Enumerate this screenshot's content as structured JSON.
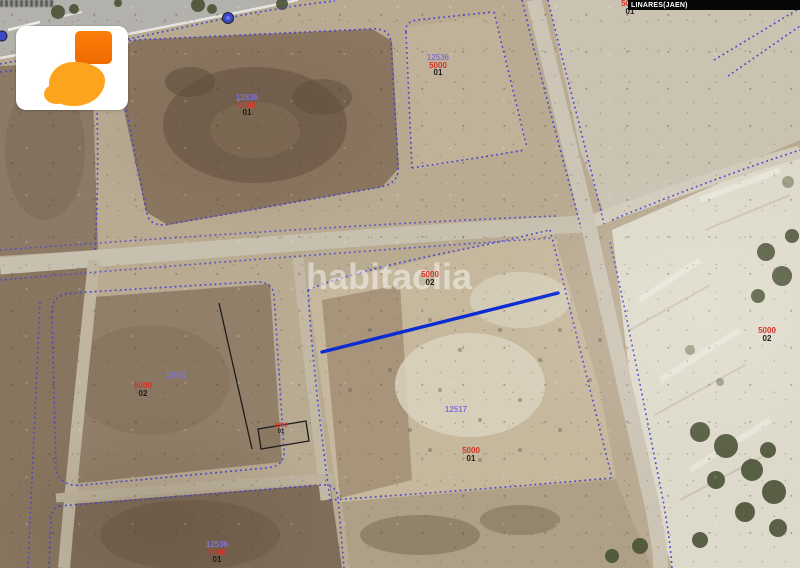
{
  "header": {
    "municipality": "LINARES(JAEN)"
  },
  "watermark": {
    "text": "habitaclia"
  },
  "logo": {
    "name": "habitaclia logo"
  },
  "colors": {
    "parcel_number_red": "#d63426",
    "polygon_number_purple": "#8272d4",
    "subparcel_black": "#1d1d1d",
    "boundary_dashed_blue": "#4945cf",
    "highlight_line_blue": "#0b2bd4",
    "municipality_bar_bg": "#070707"
  },
  "labels": [
    {
      "lines": [
        {
          "text": "5000",
          "tone": "red"
        },
        {
          "text": "01",
          "tone": "dark"
        }
      ]
    },
    {
      "lines": [
        {
          "text": "12536",
          "tone": "purple"
        },
        {
          "text": "5000",
          "tone": "red"
        },
        {
          "text": "01",
          "tone": "dark"
        }
      ]
    },
    {
      "lines": [
        {
          "text": "12536",
          "tone": "purple"
        },
        {
          "text": "5000",
          "tone": "red"
        },
        {
          "text": "01",
          "tone": "dark"
        }
      ]
    },
    {
      "lines": [
        {
          "text": "5000",
          "tone": "red"
        },
        {
          "text": "02",
          "tone": "dark"
        }
      ]
    },
    {
      "lines": [
        {
          "text": "12517",
          "tone": "purple"
        }
      ]
    },
    {
      "lines": [
        {
          "text": "5000",
          "tone": "red"
        },
        {
          "text": "02",
          "tone": "dark"
        }
      ]
    },
    {
      "lines": [
        {
          "text": "12517",
          "tone": "purple"
        }
      ]
    },
    {
      "lines": [
        {
          "text": "5000",
          "tone": "red"
        },
        {
          "text": "01",
          "tone": "dark"
        }
      ]
    },
    {
      "lines": [
        {
          "text": "5000",
          "tone": "red"
        },
        {
          "text": "02",
          "tone": "dark"
        }
      ]
    },
    {
      "lines": [
        {
          "text": "12536",
          "tone": "purple"
        },
        {
          "text": "5000",
          "tone": "red"
        },
        {
          "text": "01",
          "tone": "dark"
        }
      ]
    },
    {
      "lines": [
        {
          "text": "5000",
          "tone": "red"
        },
        {
          "text": "01",
          "tone": "dark"
        }
      ]
    }
  ]
}
